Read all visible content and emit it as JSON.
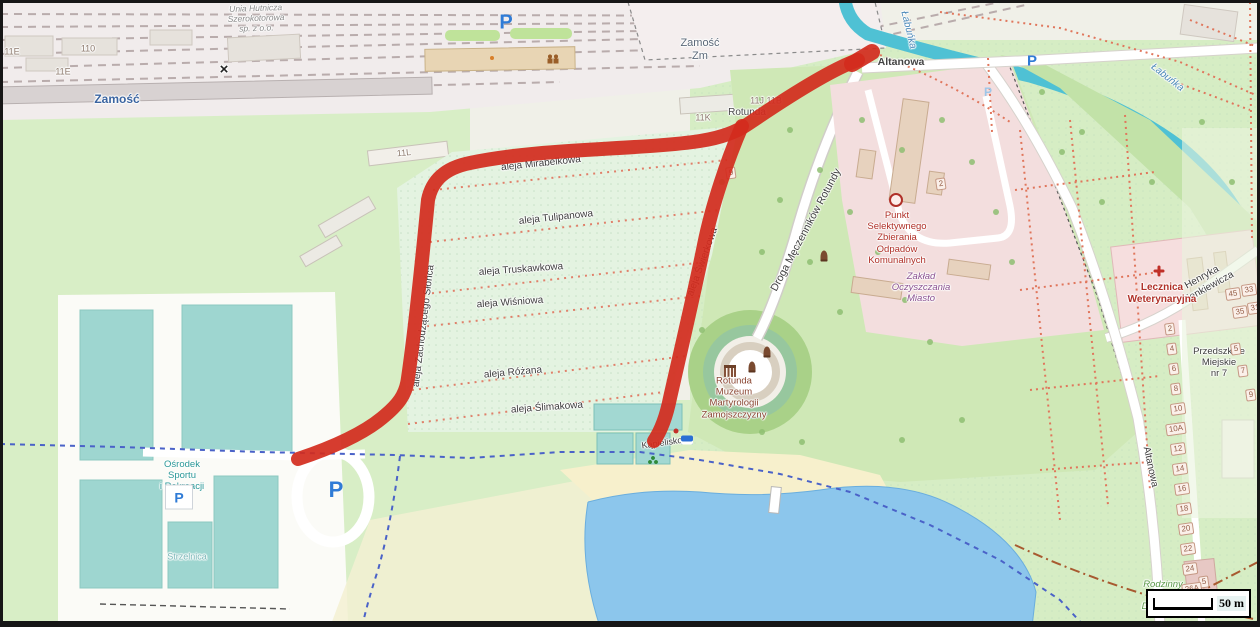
{
  "map_labels": {
    "station": "Zamość",
    "yard": "Zamość\nZm",
    "company": "Unia Hutnicza\nSzerokotorowa\nsp. z o.o.",
    "streets": {
      "altanowa_top": "Altanowa",
      "altanowa_side": "Altanowa",
      "sienkiewicza": "Henryka Sienkiewicza",
      "droga_rotundy": "Droga Męczenników Rotundy",
      "aleja_mirabelkowa": "aleja Mirabelkowa",
      "aleja_tulipanowa": "aleja Tulipanowa",
      "aleja_truskawkowa": "aleja Truskawkowa",
      "aleja_wisniowa": "aleja Wiśniowa",
      "aleja_rozana": "aleja Różana",
      "aleja_slimakowa": "aleja Ślimakowa",
      "aleja_zachodzacego": "aleja Zachodzącego Słońca",
      "aleja_swierkowa": "aleja Świerkowa"
    },
    "water": {
      "labunka_top": "Łabuńka",
      "labunka_right": "Łabuńka"
    },
    "pois": {
      "pszok": "Punkt\nSelektywnego\nZbierania\nOdpadów\nKomunalnych",
      "zaklad": "Zakład\nOczyszczania\nMiasto",
      "rotunda_muzeum": "Rotunda\nMuzeum\nMartyrologii\nZamojszczyzny",
      "rotunda_partial": "Rotunda",
      "lecznica": "Lecznica\nWeterynaryjna",
      "przedszkole": "Przedszkole\nMiejskie\nnr 7",
      "osir": "Ośrodek\nSportu\ni Rekreacji",
      "strzelnica": "Strzelnica",
      "kapielisko": "Kąpielisko",
      "rod": "Rodzinny\nOgród\nDziałkowy"
    },
    "buildings": {
      "b11e_a": "11E",
      "b110": "110",
      "b11e_b": "11E",
      "b11l": "11L",
      "b11k": "11K",
      "b11j_11b": "11J 11B",
      "b2": "2",
      "b5": "5",
      "b9": "9"
    },
    "plots_west": [
      "2",
      "4",
      "6",
      "8",
      "10",
      "10A",
      "12",
      "14",
      "16",
      "18",
      "20",
      "22",
      "24",
      "26A"
    ],
    "plots_east": [
      "45",
      "33",
      "35",
      "31",
      "5",
      "7",
      "9"
    ],
    "parking_letter": "P",
    "crossing_mark": "×",
    "scale_text": "50 m"
  },
  "colors": {
    "route_red": "#d32b1d",
    "river_blue": "#55c6d8",
    "lake_blue": "#8cc6ec",
    "park_green": "#cfe8b6",
    "field_green": "#e4f3e1",
    "pitch_teal": "#9ed6d0",
    "industrial_pink": "#f3dede",
    "poi_red": "#b03028",
    "path_blue_dashed": "#4a62c8",
    "path_red_dotted": "#e0765c"
  }
}
